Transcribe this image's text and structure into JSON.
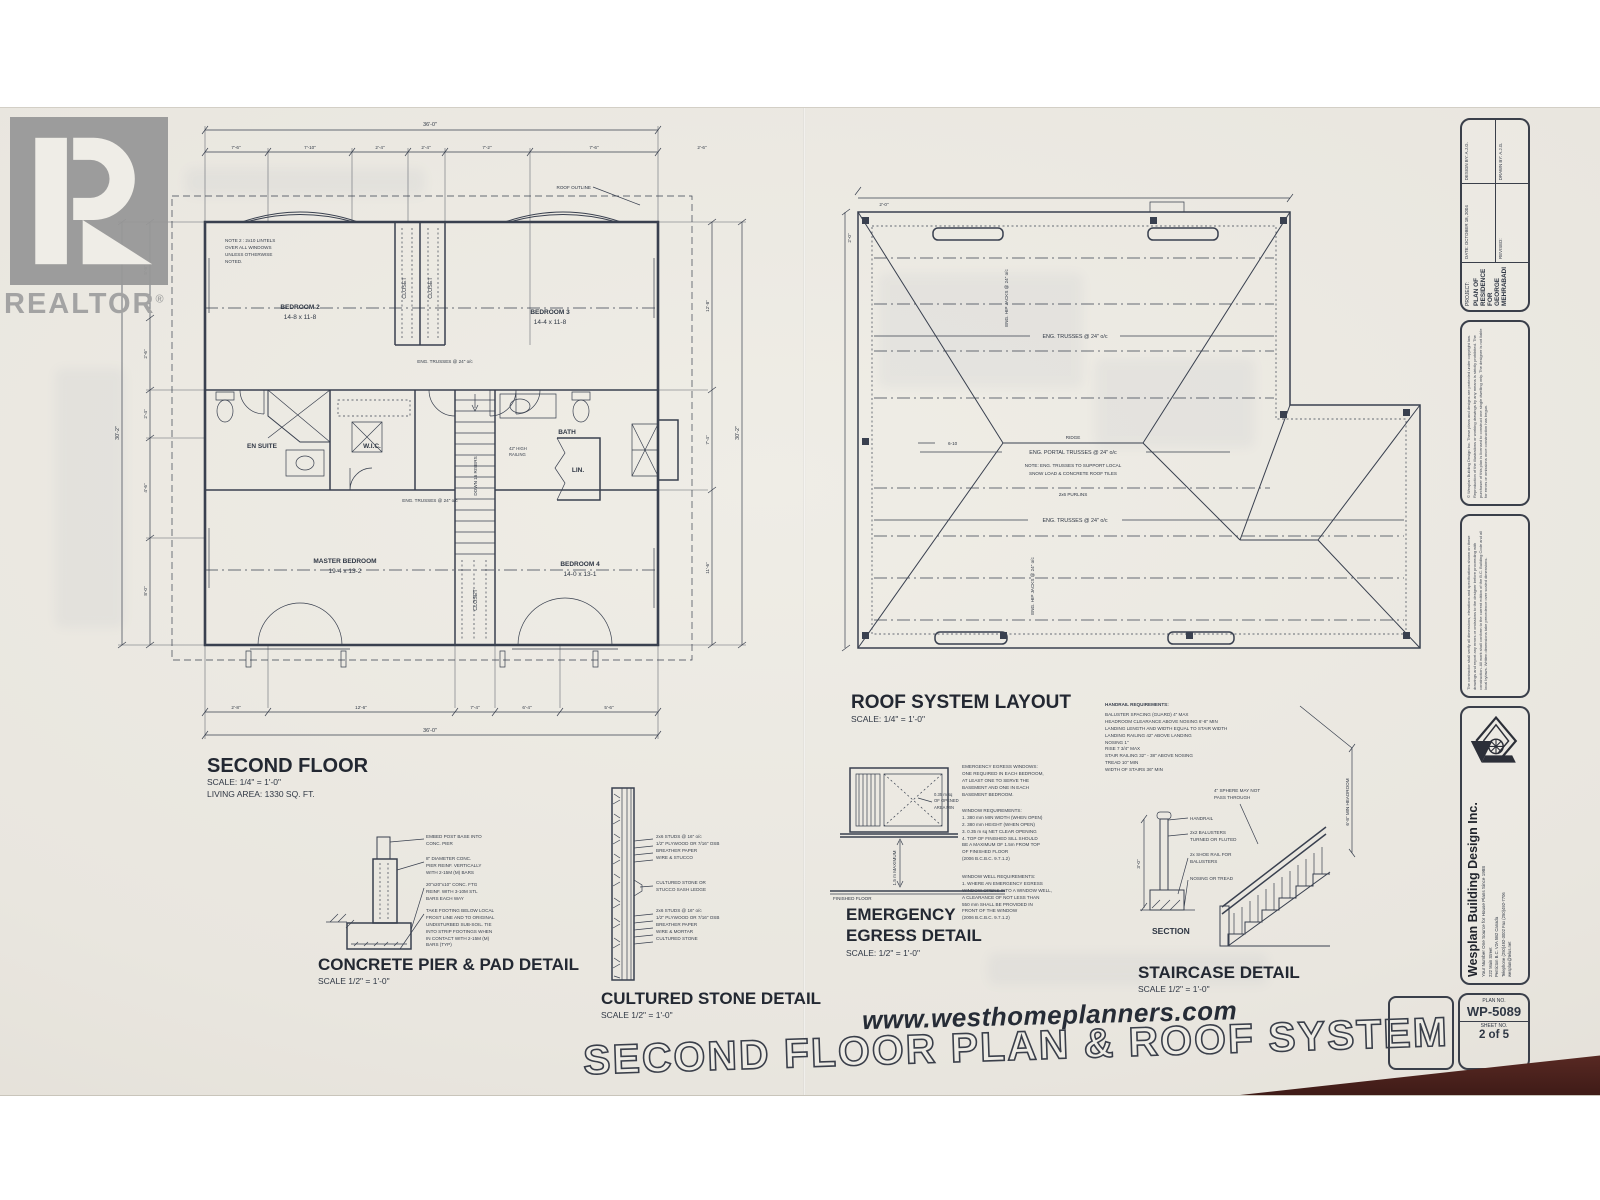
{
  "watermark": {
    "logo_text": "REALTOR",
    "reg_mark": "®"
  },
  "floor_plan": {
    "heading": "SECOND FLOOR",
    "scale": "SCALE: 1/4\" = 1'-0\"",
    "living_area": "LIVING AREA: 1330 SQ. FT.",
    "lintel_note": "NOTE 2 : 2x10 LINTELS\nOVER ALL WINDOWS\nUNLESS OTHERWISE\nNOTED.",
    "roof_outline_label": "ROOF OUTLINE",
    "rooms": {
      "bedroom2": {
        "name": "BEDROOM 2",
        "size": "14-8 x 11-8"
      },
      "bedroom3": {
        "name": "BEDROOM 3",
        "size": "14-4 x 11-8"
      },
      "master": {
        "name": "MASTER BEDROOM",
        "size": "19-4 x 13-2"
      },
      "bedroom4": {
        "name": "BEDROOM 4",
        "size": "14-0 x 13-1"
      },
      "closet": "CLOSET",
      "ensuite": "EN SUITE",
      "wic": "W.I.C.",
      "bath": "BATH",
      "linen": "LIN."
    },
    "stair_label": "DOWN 16 RISERS",
    "railing_note": "42\" HIGH\nRAILING",
    "truss_label": "ENG. TRUSSES @ 24\" o/c",
    "dims": {
      "top_total": "36'-0\"",
      "top": [
        "7'-6\"",
        "7'-10\"",
        "2'-4\"",
        "2'-4\"",
        "7'-2\"",
        "7'-6\""
      ],
      "top_right": "2'-6\"",
      "bottom": [
        "2'-8\"",
        "12'-6\"",
        "7'-4\"",
        "6'-4\"",
        "5'-6\""
      ],
      "bottom_total": "36'-0\"",
      "left": [
        "5'-8\"",
        "2'-6\"",
        "2'-4\"",
        "4'-6\"",
        "8'-0\""
      ],
      "left_total": "30'-2\"",
      "right": [
        "12'-8\"",
        "7'-4\"",
        "11'-6\""
      ],
      "right_total": "30'-2\""
    }
  },
  "roof_plan": {
    "heading": "ROOF SYSTEM LAYOUT",
    "scale": "SCALE: 1/4\" = 1'-0\"",
    "ridge_label": "RIDGE",
    "truss_label": "ENG. TRUSSES @ 24\" o/c",
    "portal_label": "ENG. PORTAL TRUSSES @ 24\" o/c",
    "hip_jack_label": "ENG. HIP JACKS @ 24\" o/c",
    "note_line1": "NOTE: ENG. TRUSSES TO SUPPORT LOCAL",
    "note_line2": "SNOW LOAD & CONCRETE ROOF TILES",
    "purlin_label": "2x6 PURLINS",
    "overhang_dim": "2'-0\"",
    "span_dim": "6-10"
  },
  "details": {
    "concrete_pier": {
      "title": "CONCRETE PIER & PAD DETAIL",
      "scale": "SCALE 1/2\" = 1'-0\"",
      "note1": "EMBED POST BASE INTO\nCONC. PIER",
      "note2": "8\" DIAMETER CONC.\nPIER REINF. VERTICALLY\nWITH 2-15M (M) BARS",
      "note3": "20\"x20\"x10\" CONC. FTG\nREINF. WITH 3-10M STL\nBARS EACH WAY",
      "note4": "TAKE FOOTING BELOW LOCAL\nFROST LINE AND TO ORIGINAL\nUNDISTURBED SUB-SOIL. TIE\nINTO STRIP FOOTINGS WHEN\nIN CONTACT WITH 2-15M (M)\nBARS (TYP)"
    },
    "cultured_stone": {
      "title": "CULTURED STONE DETAIL",
      "scale": "SCALE 1/2\" = 1'-0\"",
      "notes_top": "2x6 STUDS @ 16\" o/c\n1/2\" PLYWOOD OR 7/16\" OSB\nBREATHER PAPER\nWIRE & STUCCO",
      "note_mid": "CULTURED STONE OR\nSTUCCO SASH LEDGE",
      "notes_bottom": "2x6 STUDS @ 16\" o/c\n1/2\" PLYWOOD OR 7/16\" OSB\nBREATHER PAPER\nWIRE & MORTAR\nCULTURED STONE"
    },
    "egress": {
      "title_line1": "EMERGENCY",
      "title_line2": "EGRESS DETAIL",
      "scale": "SCALE: 1/2\" = 1'-0\"",
      "window_note": "0.35 m sq\nOF OPENED\nAREA MIN",
      "sill_dim": "1.5 m MAXIMUM",
      "floor_label": "FINISHED FLOOR",
      "para1": "EMERGENCY EGRESS WINDOWS:\nONE REQUIRED IN EACH BEDROOM,\nAT LEAST ONE TO SERVE THE\nBASEMENT AND ONE IN EACH\nBASEMENT BEDROOM.",
      "para2": "WINDOW REQUIREMENTS:\n1. 380 mm MIN WIDTH (WHEN OPEN)\n2. 380 mm HEIGHT (WHEN OPEN)\n3. 0.35 m sq NET CLEAR OPENING\n4. TOP OF FINISHED SILL SHOULD\nBE A MAXIMUM OF 1.5m FROM TOP\nOF FINISHED FLOOR\n(2006 B.C.B.C. 9.7.1.2)",
      "para3": "WINDOW WELL REQUIREMENTS:\n1. WHERE AN EMERGENCY EGRESS\nWINDOW OPENS INTO A WINDOW WELL,\nA CLEARANCE OF NOT LESS THAN\n550 mm SHALL BE PROVIDED IN\nFRONT OF THE WINDOW\n(2006 B.C.B.C. 9.7.1.2)"
    },
    "staircase": {
      "title": "STAIRCASE DETAIL",
      "scale": "SCALE 1/2\" = 1'-0\"",
      "section_label": "SECTION",
      "handrail_label": "HANDRAIL",
      "baluster_label": "2x2 BALUSTERS\nTURNED OR FLUTED",
      "shoe_label": "2x SHOE RAIL FOR\nBALUSTERS",
      "nosing_label": "NOSING OR TREAD",
      "sphere_label": "4\" SPHERE MAY NOT\nPASS THROUGH",
      "headroom_label": "6'-8\" MIN HEADROOM",
      "section_dim": "3'-0\"",
      "handrail_req_heading": "HANDRAIL REQUIREMENTS:",
      "handrail_req_lines": "BALUSTER SPACING (GUARD) 4\" MAX\nHEADROOM CLEARANCE ABOVE NOSING 6'-8\" MIN\nLANDING LENGTH AND WIDTH EQUAL TO STAIR WIDTH\nLANDING RAILING 42\" ABOVE LANDING\nNOSING 1\"\nRISE 7 3/4\" MAX\nSTAIR RAILING 32\" - 38\" ABOVE NOSING\nTREAD 10\" MIN\nWIDTH OF STAIRS 36\" MIN"
    }
  },
  "footer": {
    "website": "www.westhomeplanners.com",
    "sheet_title": "SECOND FLOOR PLAN & ROOF SYSTEM"
  },
  "title_block": {
    "project": {
      "heading": "PROJECT:",
      "line1": "PLAN OF RESIDENCE FOR",
      "line2": "GEORGE MEHRABADI",
      "design_by": "DESIGN BY: A.J.G.",
      "drawn_by": "DRAWN BY: A.J.G.",
      "date": "DATE: OCTOBER 18, 2004",
      "revised": "REVISED:"
    },
    "copyright": "© Wesplan Building Design Inc.  These plans and designs are protected under copyright law. Reproduction of the illustrations or working drawings by any means is strictly prohibited. The purchaser of this plan is licensed to construct one single dwelling only. The designer is not liable for errors or omissions once construction has begun.",
    "disclaimer": "The contractor shall verify all dimensions, elevations and specifications shown on these drawings and report any errors or omissions to the designer before proceeding with construction. All work shall conform to the current edition of the B.C. Building Code and all local bylaws. Written dimensions take precedence over scaled dimensions.",
    "firm": {
      "name": "Wesplan Building Design Inc.",
      "tagline": "Your Number One Source for House Plans Since 1988",
      "address": "222 Main Street\nPenticton B.C. V2A 5B2 Canada\nTelephone (250)492-3002   Fax (250)492-7706\nwesplan@telus.net"
    },
    "plan_label": "PLAN NO.",
    "plan_no": "WP-5089",
    "sheet_label": "SHEET NO.",
    "sheet_no": "2 of 5"
  }
}
